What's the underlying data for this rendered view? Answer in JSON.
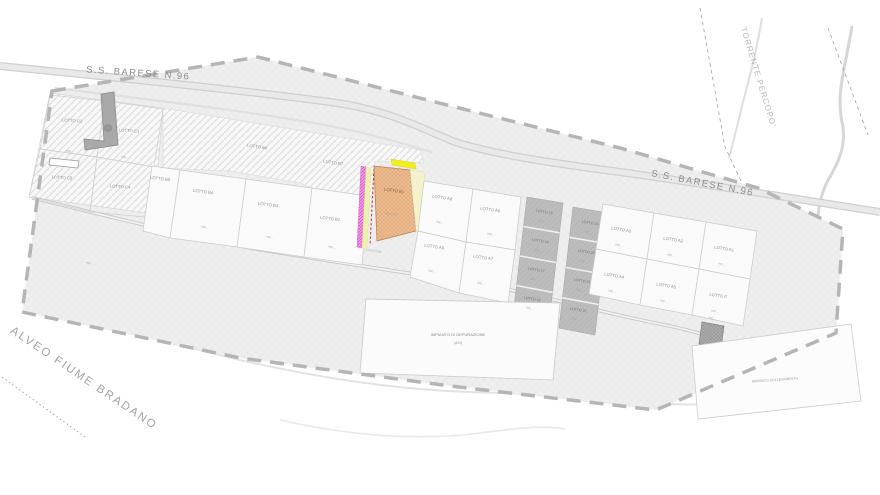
{
  "plan": {
    "roads": {
      "ss_barese_left": "S.S. BARESE N.96",
      "ss_barese_right": "S.S. BARESE N.96"
    },
    "waterways": {
      "torrente": "TORRENTE PERCOPO'",
      "alveo_fiume": "ALVEO FIUME BRADANO"
    },
    "facilities": {
      "depurazione_line1": "IMPIANTO DI DEPURAZIONE",
      "depurazione_line2": "(ASI)",
      "sollevamento": "IMPIANTO SOLLEVAMENTO",
      "cabina_area": "mq ..."
    },
    "misc_marker": "mq ...",
    "lots": {
      "c2": {
        "label": "LOTTO C2",
        "area": "mq ..."
      },
      "c1": {
        "label": "LOTTO C1",
        "area": "mq ..."
      },
      "c5": {
        "label": "LOTTO C5",
        "area": "mq ..."
      },
      "c4": {
        "label": "LOTTO C4",
        "area": "mq ..."
      },
      "b6": {
        "label": "LOTTO B6"
      },
      "b7": {
        "label": "LOTTO B7"
      },
      "b5": {
        "label": "LOTTO B5"
      },
      "b4": {
        "label": "LOTTO B4",
        "area": "mq ..."
      },
      "b3": {
        "label": "LOTTO B3",
        "area": "mq ..."
      },
      "b2": {
        "label": "LOTTO B2",
        "area": "mq ..."
      },
      "b1": {
        "label": "LOTTO B1",
        "area": "mq 1780"
      },
      "d1": {
        "label": "LOTTO D1"
      },
      "a8": {
        "label": "LOTTO A8",
        "area": "mq ..."
      },
      "a6": {
        "label": "LOTTO A6",
        "area": "mq ..."
      },
      "a9": {
        "label": "LOTTO A9",
        "area": "mq ..."
      },
      "a7": {
        "label": "LOTTO A7",
        "area": "mq ..."
      },
      "a3": {
        "label": "LOTTO A3",
        "area": "mq ..."
      },
      "a2": {
        "label": "LOTTO A2",
        "area": "mq ..."
      },
      "a1": {
        "label": "LOTTO A1",
        "area": "mq ..."
      },
      "a4": {
        "label": "LOTTO A4",
        "area": "mq ..."
      },
      "a5": {
        "label": "LOTTO A5",
        "area": "mq ..."
      },
      "f": {
        "label": "LOTTO F",
        "area": "mq ..."
      },
      "n15": {
        "label": "LOTTO 15",
        "area": "mq ..."
      },
      "n16": {
        "label": "LOTTO 16",
        "area": "mq ..."
      },
      "n17": {
        "label": "LOTTO 17",
        "area": "mq ..."
      },
      "n18": {
        "label": "LOTTO 18",
        "area": "mq ..."
      },
      "n19": {
        "label": "LOTTO 19",
        "area": "mq ..."
      },
      "n20": {
        "label": "LOTTO 20",
        "area": "mq ..."
      },
      "n21": {
        "label": "LOTTO 21",
        "area": "mq ..."
      },
      "n22": {
        "label": "LOTTO 22",
        "area": "mq ..."
      }
    },
    "colors": {
      "highlight_lot_fill": "#edbd93",
      "strip_magenta": "#e77ad8",
      "strip_yellow": "#f3ef1e",
      "gray_terraced_lots": "#bdbdbd",
      "site_fill": "#efefef",
      "boundary_dash": "#b5b5b5"
    }
  }
}
